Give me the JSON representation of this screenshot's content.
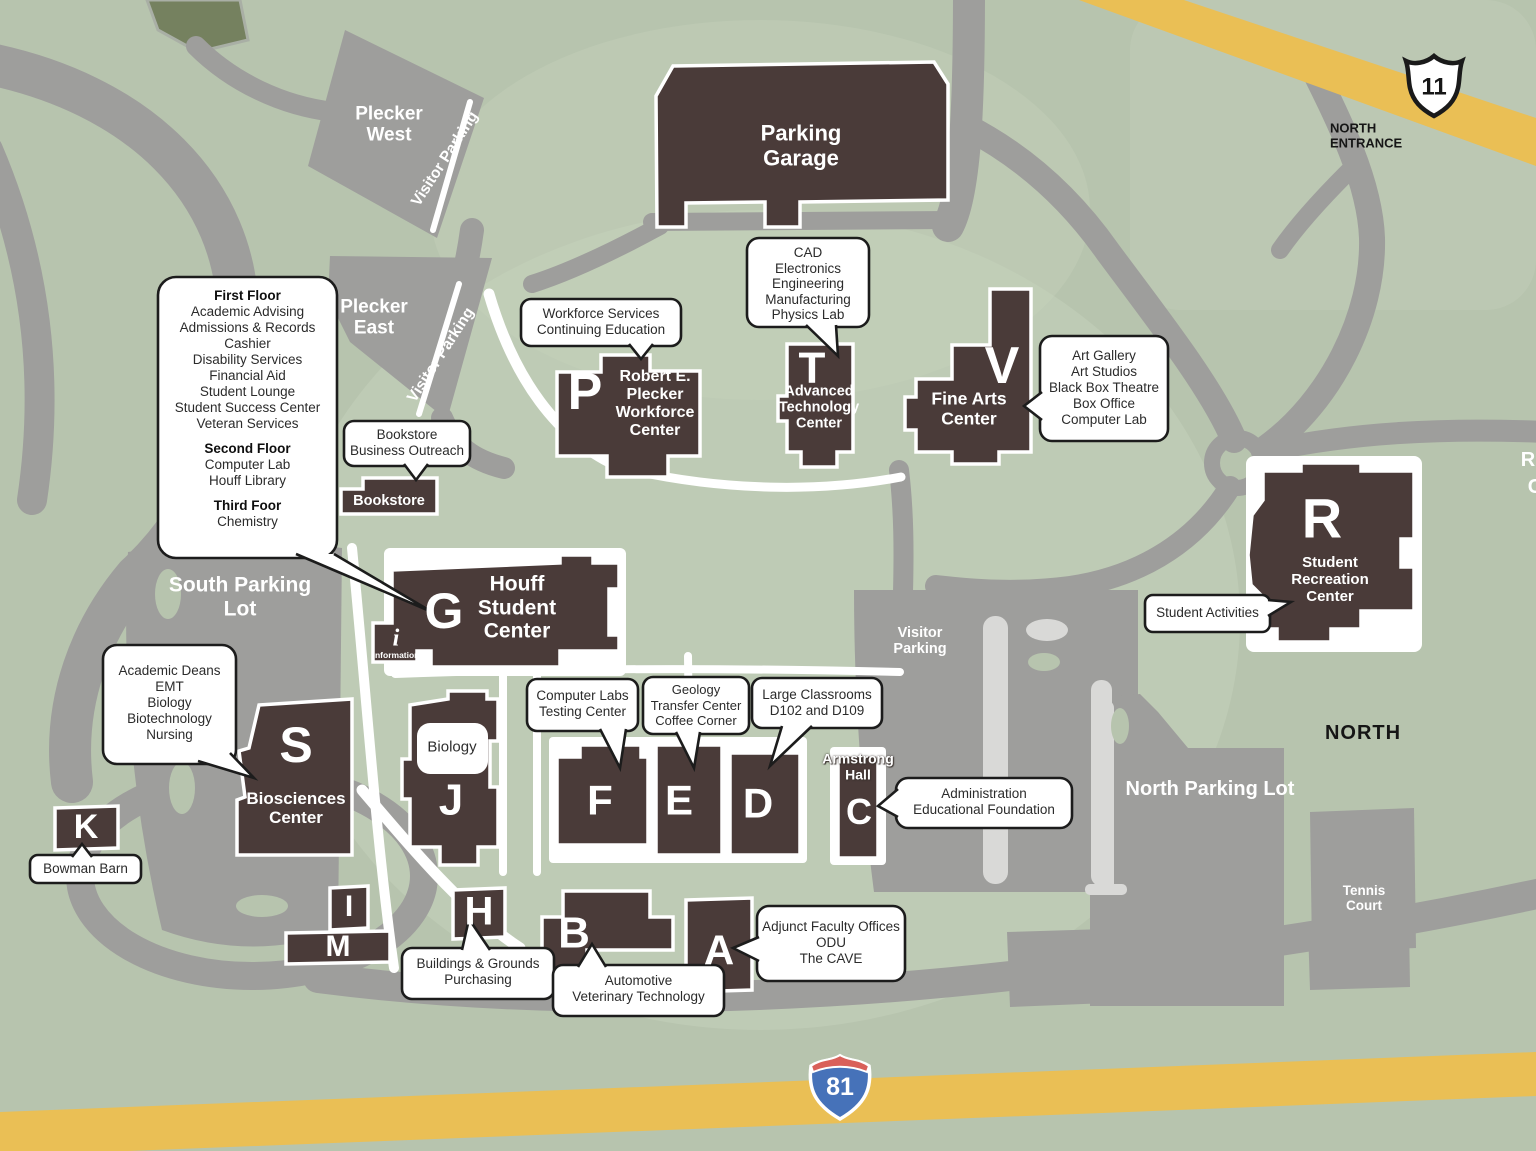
{
  "palette": {
    "background_green": "#b7c4ae",
    "light_green": "#c6d1bc",
    "road_gray": "#9e9e9c",
    "lane_light_gray": "#d9d9d7",
    "building_brown": "#4a3b39",
    "highway_yellow": "#eabf55",
    "interstate_blue": "#4672b9",
    "interstate_red": "#d9605a",
    "callout_border": "#1c1c1c"
  },
  "road_labels": {
    "us_route": "11",
    "interstate": "81",
    "north_entrance": "NORTH ENTRANCE",
    "north": "NORTH",
    "edge_partial_top": "R",
    "edge_partial_bottom": "C"
  },
  "parking_labels": {
    "garage": "Parking Garage",
    "plecker_west": "Plecker West",
    "plecker_east": "Plecker East",
    "visitor": "Visitor Parking",
    "south": "South Parking Lot",
    "north": "North Parking Lot",
    "tennis": "Tennis Court"
  },
  "buildings": {
    "p": {
      "letter": "P",
      "name": "Robert E. Plecker Workforce Center"
    },
    "t": {
      "letter": "T",
      "name": "Advanced Technology Center"
    },
    "v": {
      "letter": "V",
      "name": "Fine Arts Center"
    },
    "g": {
      "letter": "G",
      "name": "Houff Student Center"
    },
    "r": {
      "letter": "R",
      "name": "Student Recreation Center"
    },
    "s": {
      "letter": "S",
      "name": "Biosciences Center"
    },
    "c": {
      "letter": "C",
      "name": "Armstrong Hall"
    },
    "j": {
      "letter": "J",
      "tag": "Biology"
    },
    "f": {
      "letter": "F"
    },
    "e": {
      "letter": "E"
    },
    "d": {
      "letter": "D"
    },
    "k": {
      "letter": "K"
    },
    "i": {
      "letter": "I"
    },
    "m": {
      "letter": "M"
    },
    "h": {
      "letter": "H"
    },
    "b": {
      "letter": "B"
    },
    "a": {
      "letter": "A"
    },
    "bookstore": {
      "name": "Bookstore"
    }
  },
  "info_marker": {
    "symbol": "i",
    "label": "information"
  },
  "callouts": {
    "first_floor": {
      "h1": "First Floor",
      "items1": [
        "Academic Advising",
        "Admissions & Records",
        "Cashier",
        "Disability Services",
        "Financial Aid",
        "Student Lounge",
        "Student Success Center",
        "Veteran Services"
      ],
      "h2": "Second Floor",
      "items2": [
        "Computer Lab",
        "Houff Library"
      ],
      "h3": "Third Foor",
      "items3": [
        "Chemistry"
      ]
    },
    "bookstore": {
      "lines": [
        "Bookstore",
        "Business Outreach"
      ]
    },
    "workforce": {
      "lines": [
        "Workforce Services",
        "Continuing Education"
      ]
    },
    "cad": {
      "lines": [
        "CAD",
        "Electronics",
        "Engineering",
        "Manufacturing",
        "Physics Lab"
      ]
    },
    "fine_arts": {
      "lines": [
        "Art Gallery",
        "Art Studios",
        "Black Box Theatre",
        "Box Office",
        "Computer Lab"
      ]
    },
    "student_activities": {
      "lines": [
        "Student Activities"
      ]
    },
    "academic_deans": {
      "lines": [
        "Academic Deans",
        "EMT",
        "Biology",
        "Biotechnology",
        "Nursing"
      ]
    },
    "bowman_barn": {
      "lines": [
        "Bowman Barn"
      ]
    },
    "computer_labs": {
      "lines": [
        "Computer Labs",
        "Testing Center"
      ]
    },
    "geology": {
      "lines": [
        "Geology",
        "Transfer Center",
        "Coffee Corner"
      ]
    },
    "large_classrooms": {
      "lines": [
        "Large Classrooms",
        "D102 and D109"
      ]
    },
    "administration": {
      "lines": [
        "Administration",
        "Educational Foundation"
      ]
    },
    "buildings_grounds": {
      "lines": [
        "Buildings & Grounds",
        "Purchasing"
      ]
    },
    "automotive": {
      "lines": [
        "Automotive",
        "Veterinary Technology"
      ]
    },
    "adjunct": {
      "lines": [
        "Adjunct Faculty Offices",
        "ODU",
        "The CAVE"
      ]
    }
  }
}
